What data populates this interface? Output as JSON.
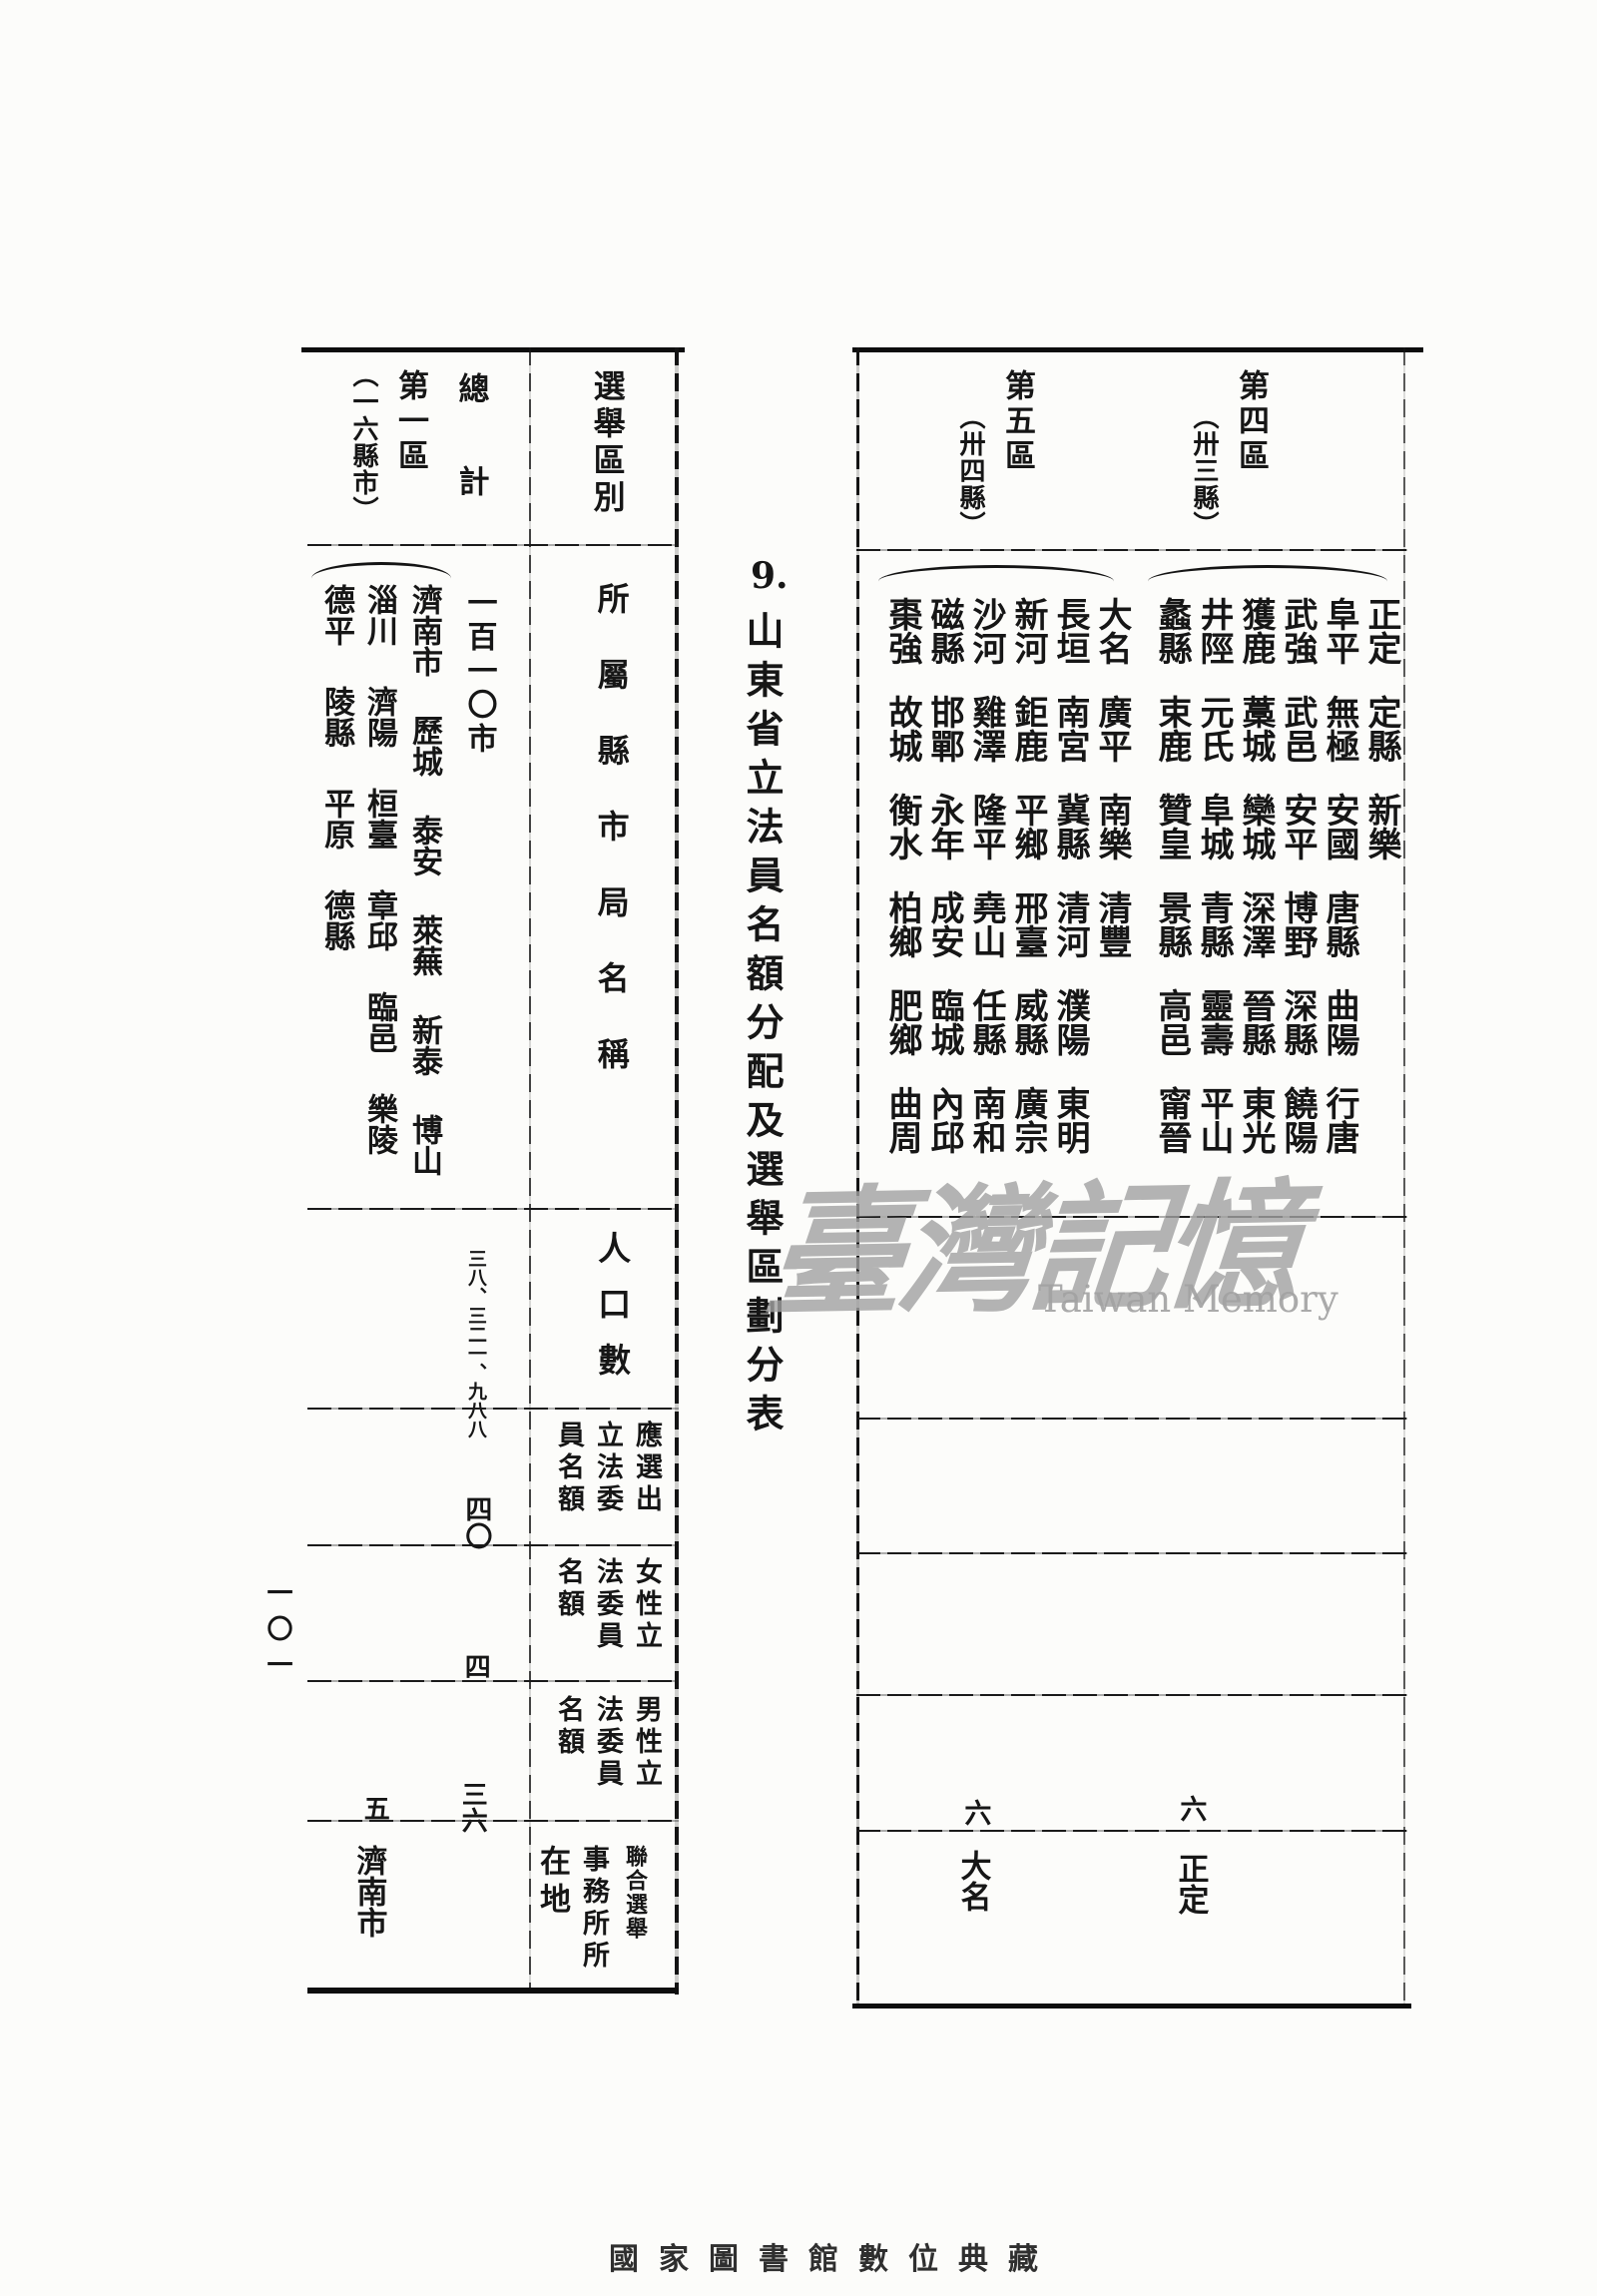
{
  "page": {
    "section_number": "9.",
    "title": "山東省立法員名額分配及選舉區劃分表",
    "page_number": "一〇一",
    "footer": "國家圖書館數位典藏"
  },
  "colors": {
    "ink": "#161616",
    "paper": "#fcfcfa",
    "watermark": "#a2a2a2",
    "footer_text": "#2f2f2f"
  },
  "watermark": {
    "cjk": "臺灣記憶",
    "latin": "Taiwan Memory"
  },
  "right_table": {
    "districts": [
      {
        "name": "第四區",
        "sub": "（卅三縣）",
        "county_rows": [
          [
            "正定",
            "阜平",
            "武強",
            "獲鹿",
            "井陘",
            "蠡縣"
          ],
          [
            "定縣",
            "無極",
            "武邑",
            "藁城",
            "元氏",
            "束鹿"
          ],
          [
            "新樂",
            "安國",
            "安平",
            "欒城",
            "阜城",
            "贊皇"
          ],
          [
            "唐縣",
            "博野",
            "深澤",
            "青縣",
            "景縣"
          ],
          [
            "曲陽",
            "深縣",
            "晉縣",
            "靈壽",
            "高邑"
          ],
          [
            "行唐",
            "饒陽",
            "東光",
            "平山",
            "甯晉"
          ]
        ],
        "male_quota": "六",
        "office": "正定"
      },
      {
        "name": "第五區",
        "sub": "（卅四縣）",
        "county_rows": [
          [
            "大名",
            "長垣",
            "新河",
            "沙河",
            "磁縣",
            "棗強"
          ],
          [
            "廣平",
            "南宮",
            "鉅鹿",
            "雞澤",
            "邯鄲",
            "故城"
          ],
          [
            "南樂",
            "冀縣",
            "平鄉",
            "隆平",
            "永年",
            "衡水"
          ],
          [
            "清豐",
            "清河",
            "邢臺",
            "堯山",
            "成安",
            "柏鄉"
          ],
          [
            "濮陽",
            "威縣",
            "任縣",
            "臨城",
            "肥鄉"
          ],
          [
            "東明",
            "廣宗",
            "南和",
            "內邱",
            "曲周"
          ]
        ],
        "male_quota": "六",
        "office": "大名"
      }
    ]
  },
  "left_table": {
    "headers": {
      "district_label": "選舉區別",
      "col_total": "總計",
      "col_district1": "第一區",
      "col_district1_sub": "（一六縣市）"
    },
    "row_labels": {
      "names": "所屬縣市局名稱",
      "population": "人口數",
      "quota": [
        "應選出",
        "立法委",
        "員名額"
      ],
      "female": [
        "女性立",
        "法委員",
        "名額"
      ],
      "male": [
        "男性立",
        "法委員",
        "名額"
      ],
      "office": [
        "聯合選舉",
        "事務所所",
        "在地"
      ]
    },
    "total": {
      "names": "一百一〇市",
      "population": "三八、三二一、九八八",
      "quota": "四〇",
      "female": "四",
      "male": "三六"
    },
    "district1": {
      "col_right": [
        "濟南市",
        "歷城",
        "泰安",
        "萊蕪",
        "新泰",
        "博山"
      ],
      "col_mid": [
        "淄川",
        "濟陽",
        "桓臺",
        "章邱",
        "臨邑",
        "樂陵"
      ],
      "col_left": [
        "德平",
        "陵縣",
        "平原",
        "德縣"
      ],
      "male": "五",
      "office": "濟南市"
    }
  }
}
